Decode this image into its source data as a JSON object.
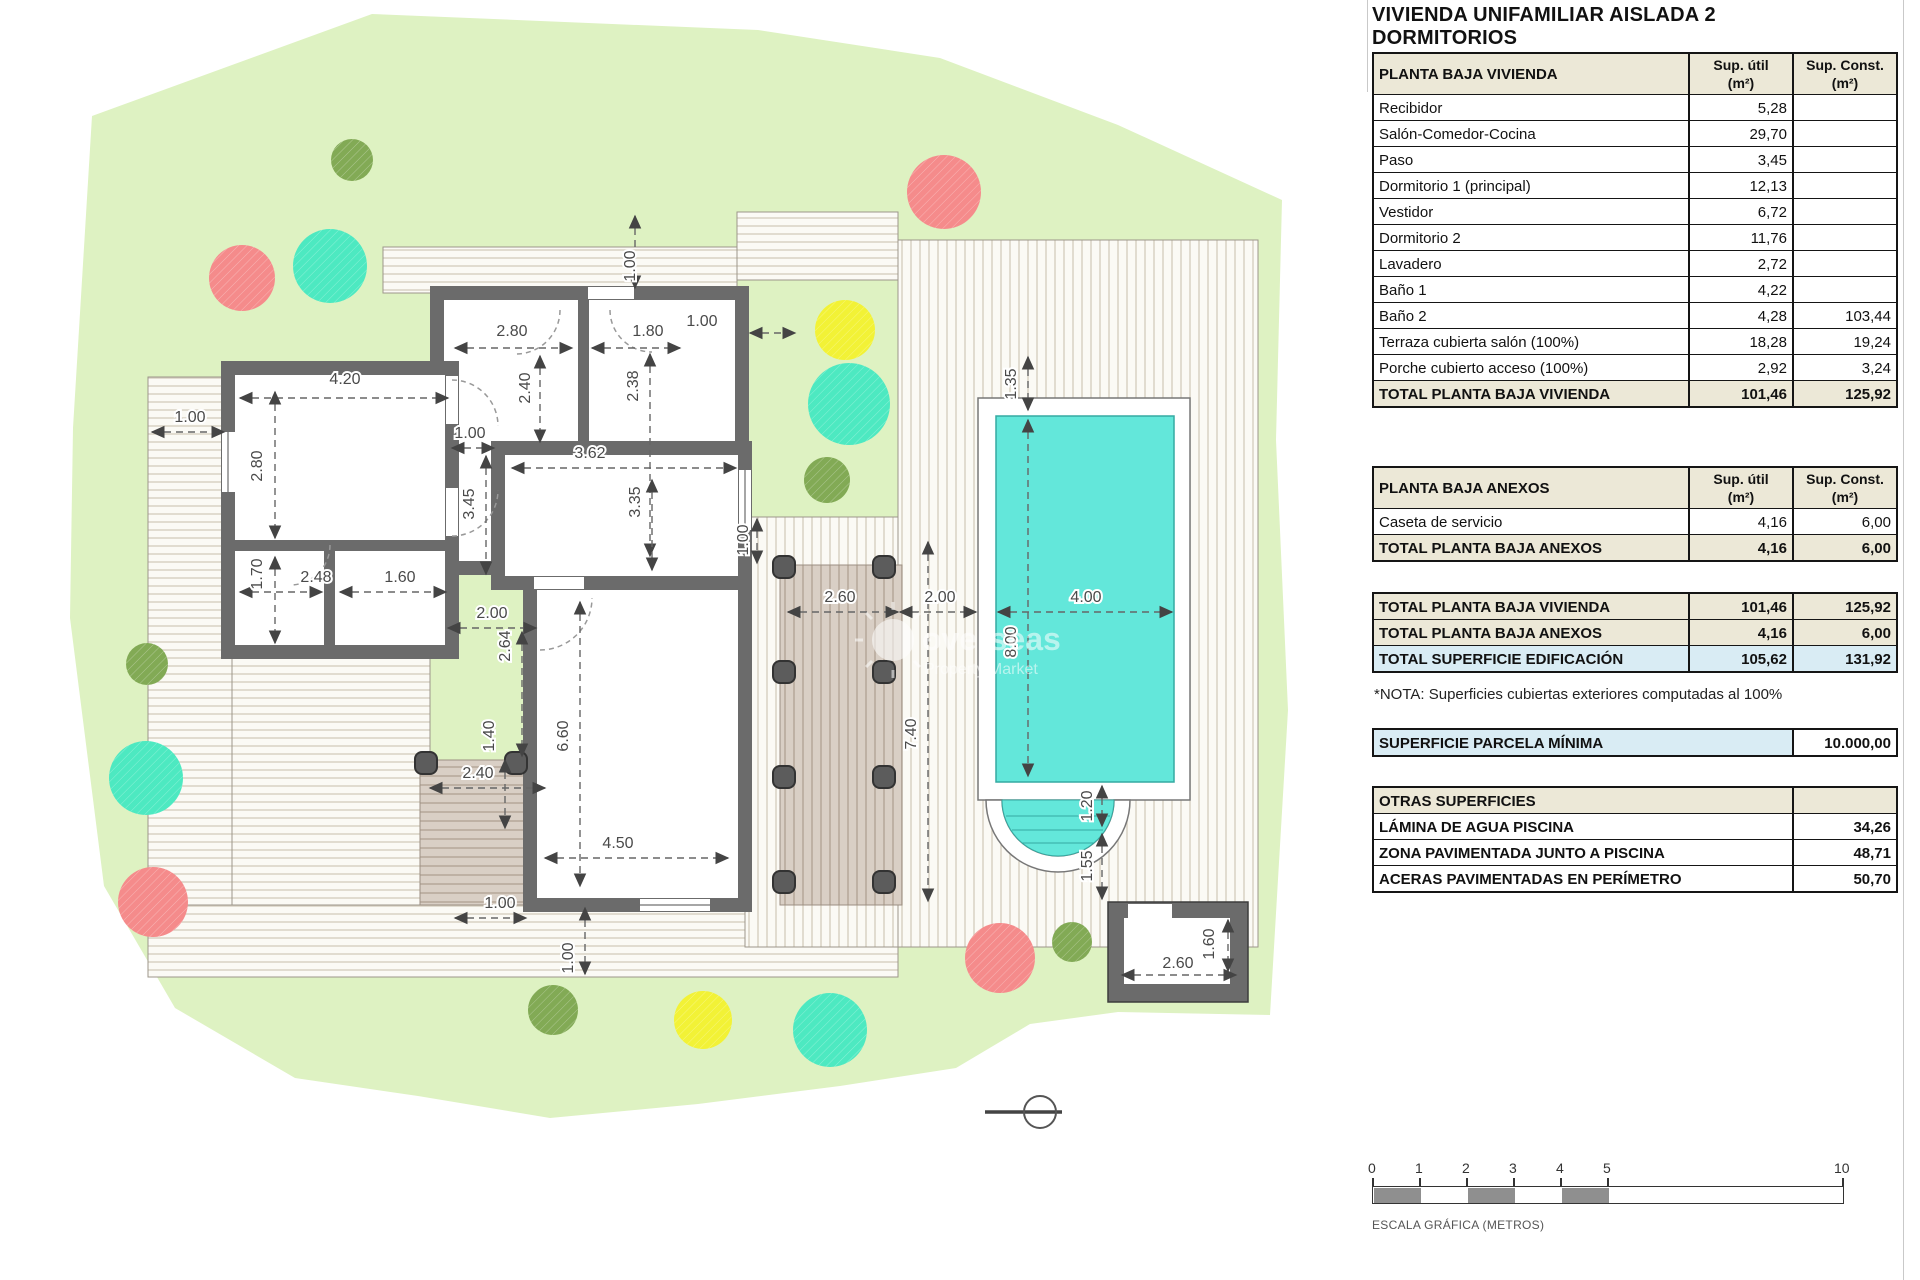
{
  "title": "VIVIENDA UNIFAMILIAR AISLADA 2 DORMITORIOS",
  "col_headers": {
    "util_1": "Sup. útil",
    "util_2": "(m²)",
    "const_1": "Sup. Const.",
    "const_2": "(m²)"
  },
  "tables": {
    "vivienda": {
      "header": "PLANTA BAJA VIVIENDA",
      "rows": [
        [
          "Recibidor",
          "5,28",
          ""
        ],
        [
          "Salón-Comedor-Cocina",
          "29,70",
          ""
        ],
        [
          "Paso",
          "3,45",
          ""
        ],
        [
          "Dormitorio 1 (principal)",
          "12,13",
          ""
        ],
        [
          "Vestidor",
          "6,72",
          ""
        ],
        [
          "Dormitorio 2",
          "11,76",
          ""
        ],
        [
          "Lavadero",
          "2,72",
          ""
        ],
        [
          "Baño 1",
          "4,22",
          ""
        ],
        [
          "Baño 2",
          "4,28",
          "103,44"
        ],
        [
          "Terraza cubierta salón (100%)",
          "18,28",
          "19,24"
        ],
        [
          "Porche cubierto acceso (100%)",
          "2,92",
          "3,24"
        ]
      ],
      "total": [
        "TOTAL PLANTA BAJA VIVIENDA",
        "101,46",
        "125,92"
      ]
    },
    "anexos": {
      "header": "PLANTA BAJA ANEXOS",
      "rows": [
        [
          "Caseta de servicio",
          "4,16",
          "6,00"
        ]
      ],
      "total": [
        "TOTAL PLANTA BAJA ANEXOS",
        "4,16",
        "6,00"
      ]
    },
    "resumen": {
      "rows": [
        {
          "label": "TOTAL PLANTA BAJA VIVIENDA",
          "v1": "101,46",
          "v2": "125,92",
          "style": "tot"
        },
        {
          "label": "TOTAL PLANTA BAJA ANEXOS",
          "v1": "4,16",
          "v2": "6,00",
          "style": "tot"
        },
        {
          "label": "TOTAL SUPERFICIE EDIFICACIÓN",
          "v1": "105,62",
          "v2": "131,92",
          "style": "blue"
        }
      ]
    },
    "nota": "*NOTA: Superficies cubiertas exteriores computadas al 100%",
    "parcela": {
      "label": "SUPERFICIE PARCELA MÍNIMA",
      "value": "10.000,00"
    },
    "otras": {
      "header": "OTRAS SUPERFICIES",
      "rows": [
        [
          "LÁMINA DE AGUA PISCINA",
          "34,26"
        ],
        [
          "ZONA PAVIMENTADA JUNTO A PISCINA",
          "48,71"
        ],
        [
          "ACERAS PAVIMENTADAS EN PERÍMETRO",
          "50,70"
        ]
      ]
    }
  },
  "scalebar": {
    "ticks": [
      0,
      1,
      2,
      3,
      4,
      5,
      10
    ],
    "caption": "ESCALA GRÁFICA (METROS)",
    "fill_color": "#8f8f8f"
  },
  "watermark": {
    "line1": "overseas",
    "line2": "Property Market"
  },
  "plan": {
    "colors": {
      "parcel": "#def2c2",
      "wall": "#6b6b6b",
      "pool": "#63e7da",
      "pool_edge": "#35aaa2",
      "deck_line": "#d3ccbd",
      "pergola_bg": "#d9cfc5",
      "pergola_line": "#b3a496",
      "post": "#5c5c5c",
      "dim": "#555555",
      "tree_red": "#f58b8b",
      "tree_teal": "#4de9c1",
      "tree_yellow": "#f2f236",
      "tree_green": "#82aa55"
    },
    "dim_labels": [
      {
        "t": "1.00",
        "x": 635,
        "y": 266,
        "v": 1
      },
      {
        "t": "2.80",
        "x": 512,
        "y": 336,
        "v": 0
      },
      {
        "t": "1.80",
        "x": 648,
        "y": 336,
        "v": 0
      },
      {
        "t": "1.00",
        "x": 702,
        "y": 326,
        "v": 0
      },
      {
        "t": "4.20",
        "x": 345,
        "y": 384,
        "v": 0
      },
      {
        "t": "1.00",
        "x": 190,
        "y": 422,
        "v": 0
      },
      {
        "t": "2.80",
        "x": 262,
        "y": 466,
        "v": 1
      },
      {
        "t": "2.40",
        "x": 530,
        "y": 388,
        "v": 1
      },
      {
        "t": "2.38",
        "x": 638,
        "y": 386,
        "v": 1
      },
      {
        "t": "1.00",
        "x": 470,
        "y": 438,
        "v": 0
      },
      {
        "t": "3.62",
        "x": 590,
        "y": 458,
        "v": 0
      },
      {
        "t": "3.45",
        "x": 474,
        "y": 504,
        "v": 1
      },
      {
        "t": "3.35",
        "x": 640,
        "y": 502,
        "v": 1
      },
      {
        "t": "1.00",
        "x": 748,
        "y": 540,
        "v": 1
      },
      {
        "t": "1.70",
        "x": 262,
        "y": 574,
        "v": 1
      },
      {
        "t": "2.48",
        "x": 316,
        "y": 582,
        "v": 0
      },
      {
        "t": "1.60",
        "x": 400,
        "y": 582,
        "v": 0
      },
      {
        "t": "2.00",
        "x": 492,
        "y": 618,
        "v": 0
      },
      {
        "t": "2.64",
        "x": 510,
        "y": 646,
        "v": 1
      },
      {
        "t": "1.40",
        "x": 494,
        "y": 736,
        "v": 1
      },
      {
        "t": "2.40",
        "x": 478,
        "y": 778,
        "v": 0
      },
      {
        "t": "6.60",
        "x": 568,
        "y": 736,
        "v": 1
      },
      {
        "t": "4.50",
        "x": 618,
        "y": 848,
        "v": 0
      },
      {
        "t": "1.00",
        "x": 500,
        "y": 908,
        "v": 0
      },
      {
        "t": "1.00",
        "x": 573,
        "y": 958,
        "v": 1
      },
      {
        "t": "2.60",
        "x": 840,
        "y": 602,
        "v": 0
      },
      {
        "t": "2.00",
        "x": 940,
        "y": 602,
        "v": 0
      },
      {
        "t": "4.00",
        "x": 1086,
        "y": 602,
        "v": 0
      },
      {
        "t": "8.00",
        "x": 1016,
        "y": 642,
        "v": 1
      },
      {
        "t": "1.35",
        "x": 1016,
        "y": 384,
        "v": 1
      },
      {
        "t": "7.40",
        "x": 916,
        "y": 734,
        "v": 1
      },
      {
        "t": "1.20",
        "x": 1092,
        "y": 806,
        "v": 1
      },
      {
        "t": "1.55",
        "x": 1092,
        "y": 866,
        "v": 1
      },
      {
        "t": "2.60",
        "x": 1178,
        "y": 968,
        "v": 0
      },
      {
        "t": "1.60",
        "x": 1214,
        "y": 944,
        "v": 1
      }
    ],
    "trees": [
      {
        "x": 352,
        "y": 160,
        "r": 21,
        "c": "tree_green"
      },
      {
        "x": 242,
        "y": 278,
        "r": 33,
        "c": "tree_red"
      },
      {
        "x": 330,
        "y": 266,
        "r": 37,
        "c": "tree_teal"
      },
      {
        "x": 944,
        "y": 192,
        "r": 37,
        "c": "tree_red"
      },
      {
        "x": 845,
        "y": 330,
        "r": 30,
        "c": "tree_yellow"
      },
      {
        "x": 849,
        "y": 404,
        "r": 41,
        "c": "tree_teal"
      },
      {
        "x": 827,
        "y": 480,
        "r": 23,
        "c": "tree_green"
      },
      {
        "x": 147,
        "y": 664,
        "r": 21,
        "c": "tree_green"
      },
      {
        "x": 146,
        "y": 778,
        "r": 37,
        "c": "tree_teal"
      },
      {
        "x": 153,
        "y": 902,
        "r": 35,
        "c": "tree_red"
      },
      {
        "x": 553,
        "y": 1010,
        "r": 25,
        "c": "tree_green"
      },
      {
        "x": 703,
        "y": 1020,
        "r": 29,
        "c": "tree_yellow"
      },
      {
        "x": 830,
        "y": 1030,
        "r": 37,
        "c": "tree_teal"
      },
      {
        "x": 1000,
        "y": 958,
        "r": 35,
        "c": "tree_red"
      },
      {
        "x": 1072,
        "y": 942,
        "r": 20,
        "c": "tree_green"
      }
    ]
  }
}
